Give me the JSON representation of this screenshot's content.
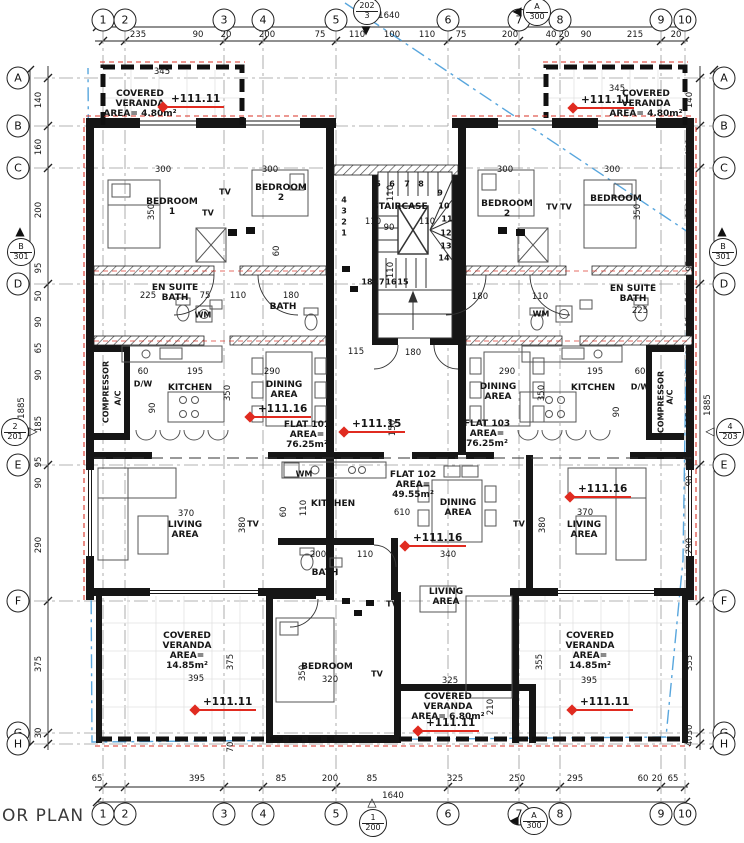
{
  "meta": {
    "plan_label": "OR PLAN"
  },
  "colors": {
    "wall": "#161616",
    "grid_line": "#9a9a9a",
    "chain_line": "#222222",
    "boundary_blue": "#58a6dd",
    "insulation_red": "#d93025",
    "elevation_red": "#e02b20"
  },
  "overall_dimensions": {
    "top": "1640",
    "bottom": "1640",
    "left": "1885",
    "right": "1885"
  },
  "grid": {
    "columns": [
      {
        "label": "1",
        "x": 103
      },
      {
        "label": "2",
        "x": 125
      },
      {
        "label": "3",
        "x": 224
      },
      {
        "label": "4",
        "x": 263
      },
      {
        "label": "5",
        "x": 336
      },
      {
        "label": "6",
        "x": 448
      },
      {
        "label": "7",
        "x": 519
      },
      {
        "label": "8",
        "x": 560
      },
      {
        "label": "9",
        "x": 661
      },
      {
        "label": "10",
        "x": 685
      }
    ],
    "rows": [
      {
        "label": "A",
        "y": 78
      },
      {
        "label": "B",
        "y": 126
      },
      {
        "label": "C",
        "y": 168
      },
      {
        "label": "D",
        "y": 284
      },
      {
        "label": "E",
        "y": 465
      },
      {
        "label": "F",
        "y": 601
      },
      {
        "label": "G",
        "y": 733
      },
      {
        "label": "H",
        "y": 744
      }
    ]
  },
  "dimensions": {
    "top": [
      {
        "t": "235",
        "x": 138
      },
      {
        "t": "90",
        "x": 198
      },
      {
        "t": "20",
        "x": 226
      },
      {
        "t": "200",
        "x": 267
      },
      {
        "t": "75",
        "x": 320
      },
      {
        "t": "110",
        "x": 357
      },
      {
        "t": "100",
        "x": 392
      },
      {
        "t": "110",
        "x": 427
      },
      {
        "t": "75",
        "x": 461
      },
      {
        "t": "200",
        "x": 510
      },
      {
        "t": "40",
        "x": 551
      },
      {
        "t": "20",
        "x": 564
      },
      {
        "t": "90",
        "x": 586
      },
      {
        "t": "215",
        "x": 635
      },
      {
        "t": "20",
        "x": 676
      }
    ],
    "bottom": [
      {
        "t": "65",
        "x": 97
      },
      {
        "t": "395",
        "x": 197
      },
      {
        "t": "85",
        "x": 281
      },
      {
        "t": "200",
        "x": 330
      },
      {
        "t": "85",
        "x": 372
      },
      {
        "t": "325",
        "x": 455
      },
      {
        "t": "250",
        "x": 517
      },
      {
        "t": "295",
        "x": 575
      },
      {
        "t": "60",
        "x": 643
      },
      {
        "t": "20",
        "x": 657
      },
      {
        "t": "65",
        "x": 673
      }
    ],
    "left": [
      {
        "t": "140",
        "y": 100
      },
      {
        "t": "160",
        "y": 147
      },
      {
        "t": "200",
        "y": 210
      },
      {
        "t": "95",
        "y": 268
      },
      {
        "t": "50",
        "y": 296
      },
      {
        "t": "90",
        "y": 322
      },
      {
        "t": "65",
        "y": 348
      },
      {
        "t": "90",
        "y": 375
      },
      {
        "t": "185",
        "y": 424
      },
      {
        "t": "95",
        "y": 462
      },
      {
        "t": "90",
        "y": 483
      },
      {
        "t": "290",
        "y": 545
      },
      {
        "t": "375",
        "y": 664
      },
      {
        "t": "30",
        "y": 733
      }
    ],
    "right": [
      {
        "t": "140",
        "y": 100
      },
      {
        "t": "160",
        "y": 147
      },
      {
        "t": "200",
        "y": 210
      },
      {
        "t": "95",
        "y": 266
      },
      {
        "t": "50",
        "y": 297
      },
      {
        "t": "95",
        "y": 322
      },
      {
        "t": "60",
        "y": 350
      },
      {
        "t": "90",
        "y": 375
      },
      {
        "t": "185",
        "y": 420
      },
      {
        "t": "95",
        "y": 461
      },
      {
        "t": "90",
        "y": 481
      },
      {
        "t": "290",
        "y": 546
      },
      {
        "t": "355",
        "y": 663
      },
      {
        "t": "30",
        "y": 730
      },
      {
        "t": "40",
        "y": 741
      }
    ],
    "inner_h": [
      {
        "t": "345",
        "x": 162,
        "y": 72
      },
      {
        "t": "345",
        "x": 617,
        "y": 89
      },
      {
        "t": "300",
        "x": 163,
        "y": 170
      },
      {
        "t": "300",
        "x": 270,
        "y": 170
      },
      {
        "t": "300",
        "x": 505,
        "y": 170
      },
      {
        "t": "300",
        "x": 612,
        "y": 170
      },
      {
        "t": "225",
        "x": 148,
        "y": 296
      },
      {
        "t": "75",
        "x": 205,
        "y": 296
      },
      {
        "t": "110",
        "x": 238,
        "y": 296
      },
      {
        "t": "180",
        "x": 291,
        "y": 296
      },
      {
        "t": "180",
        "x": 480,
        "y": 297
      },
      {
        "t": "110",
        "x": 540,
        "y": 297
      },
      {
        "t": "225",
        "x": 640,
        "y": 311
      },
      {
        "t": "60",
        "x": 143,
        "y": 372
      },
      {
        "t": "195",
        "x": 195,
        "y": 372
      },
      {
        "t": "290",
        "x": 272,
        "y": 372
      },
      {
        "t": "290",
        "x": 507,
        "y": 372
      },
      {
        "t": "195",
        "x": 595,
        "y": 372
      },
      {
        "t": "60",
        "x": 640,
        "y": 372
      },
      {
        "t": "110",
        "x": 373,
        "y": 222
      },
      {
        "t": "90",
        "x": 389,
        "y": 228
      },
      {
        "t": "110",
        "x": 427,
        "y": 222
      },
      {
        "t": "115",
        "x": 356,
        "y": 352
      },
      {
        "t": "180",
        "x": 413,
        "y": 353
      },
      {
        "t": "610",
        "x": 402,
        "y": 513
      },
      {
        "t": "200",
        "x": 318,
        "y": 555
      },
      {
        "t": "110",
        "x": 365,
        "y": 555
      },
      {
        "t": "340",
        "x": 448,
        "y": 555
      },
      {
        "t": "370",
        "x": 186,
        "y": 514
      },
      {
        "t": "370",
        "x": 585,
        "y": 513
      },
      {
        "t": "395",
        "x": 196,
        "y": 679
      },
      {
        "t": "395",
        "x": 589,
        "y": 681
      },
      {
        "t": "325",
        "x": 450,
        "y": 681
      },
      {
        "t": "320",
        "x": 330,
        "y": 680
      }
    ],
    "inner_v": [
      {
        "t": "350",
        "x": 152,
        "y": 212
      },
      {
        "t": "350",
        "x": 638,
        "y": 212
      },
      {
        "t": "350",
        "x": 228,
        "y": 393
      },
      {
        "t": "350",
        "x": 542,
        "y": 393
      },
      {
        "t": "150",
        "x": 393,
        "y": 428
      },
      {
        "t": "110",
        "x": 391,
        "y": 193
      },
      {
        "t": "110",
        "x": 391,
        "y": 270
      },
      {
        "t": "110",
        "x": 304,
        "y": 508
      },
      {
        "t": "60",
        "x": 284,
        "y": 512
      },
      {
        "t": "380",
        "x": 243,
        "y": 525
      },
      {
        "t": "380",
        "x": 543,
        "y": 525
      },
      {
        "t": "375",
        "x": 231,
        "y": 662
      },
      {
        "t": "355",
        "x": 540,
        "y": 662
      },
      {
        "t": "210",
        "x": 491,
        "y": 707
      },
      {
        "t": "350",
        "x": 303,
        "y": 673
      },
      {
        "t": "70",
        "x": 231,
        "y": 747
      },
      {
        "t": "90",
        "x": 153,
        "y": 408
      },
      {
        "t": "90",
        "x": 617,
        "y": 412
      },
      {
        "t": "60",
        "x": 277,
        "y": 251
      }
    ]
  },
  "rooms": [
    {
      "id": "covered-veranda-top-left",
      "lines": [
        "COVERED",
        "VERANDA",
        "AREA= 4.80m²"
      ],
      "x": 140,
      "y": 104
    },
    {
      "id": "covered-veranda-top-right",
      "lines": [
        "COVERED",
        "VERANDA",
        "AREA= 4.80m²"
      ],
      "x": 646,
      "y": 104
    },
    {
      "id": "bedroom-1-left",
      "lines": [
        "BEDROOM",
        "1"
      ],
      "x": 172,
      "y": 207
    },
    {
      "id": "bedroom-2-left",
      "lines": [
        "BEDROOM",
        "2"
      ],
      "x": 281,
      "y": 193
    },
    {
      "id": "staircase",
      "lines": [
        "STAIRCASE"
      ],
      "x": 400,
      "y": 207
    },
    {
      "id": "bedroom-2-right",
      "lines": [
        "BEDROOM",
        "2"
      ],
      "x": 507,
      "y": 209
    },
    {
      "id": "bedroom-right",
      "lines": [
        "BEDROOM"
      ],
      "x": 616,
      "y": 199
    },
    {
      "id": "en-suite-bath-left",
      "lines": [
        "EN SUITE",
        "BATH"
      ],
      "x": 175,
      "y": 293
    },
    {
      "id": "bath-left",
      "lines": [
        "BATH"
      ],
      "x": 283,
      "y": 307
    },
    {
      "id": "en-suite-bath-right",
      "lines": [
        "EN SUITE",
        "BATH"
      ],
      "x": 633,
      "y": 294
    },
    {
      "id": "kitchen-left",
      "lines": [
        "KITCHEN"
      ],
      "x": 190,
      "y": 388
    },
    {
      "id": "dining-area-left",
      "lines": [
        "DINING",
        "AREA"
      ],
      "x": 284,
      "y": 390
    },
    {
      "id": "kitchen-right",
      "lines": [
        "KITCHEN"
      ],
      "x": 593,
      "y": 388
    },
    {
      "id": "dining-area-right",
      "lines": [
        "DINING",
        "AREA"
      ],
      "x": 498,
      "y": 392
    },
    {
      "id": "flat-101",
      "lines": [
        "FLAT 101",
        "AREA=",
        "76.25m²"
      ],
      "x": 307,
      "y": 435
    },
    {
      "id": "flat-103",
      "lines": [
        "FLAT 103",
        "AREA=",
        "76.25m²"
      ],
      "x": 487,
      "y": 434
    },
    {
      "id": "flat-102",
      "lines": [
        "FLAT 102",
        "AREA=",
        "49.55m²"
      ],
      "x": 413,
      "y": 485
    },
    {
      "id": "kitchen-center",
      "lines": [
        "KITCHEN"
      ],
      "x": 333,
      "y": 504
    },
    {
      "id": "dining-area-center",
      "lines": [
        "DINING",
        "AREA"
      ],
      "x": 458,
      "y": 508
    },
    {
      "id": "living-area-left",
      "lines": [
        "LIVING",
        "AREA"
      ],
      "x": 185,
      "y": 530
    },
    {
      "id": "living-area-right",
      "lines": [
        "LIVING",
        "AREA"
      ],
      "x": 584,
      "y": 530
    },
    {
      "id": "bath-center",
      "lines": [
        "BATH"
      ],
      "x": 325,
      "y": 573
    },
    {
      "id": "living-area-center",
      "lines": [
        "LIVING",
        "AREA"
      ],
      "x": 446,
      "y": 597
    },
    {
      "id": "bedroom-bottom",
      "lines": [
        "BEDROOM"
      ],
      "x": 327,
      "y": 667
    },
    {
      "id": "covered-veranda-bottom-left",
      "lines": [
        "COVERED",
        "VERANDA",
        "AREA=",
        "14.85m²"
      ],
      "x": 187,
      "y": 651
    },
    {
      "id": "covered-veranda-bottom-right",
      "lines": [
        "COVERED",
        "VERANDA",
        "AREA=",
        "14.85m²"
      ],
      "x": 590,
      "y": 651
    },
    {
      "id": "covered-veranda-bottom-center",
      "lines": [
        "COVERED",
        "VERANDA",
        "AREA= 6.80m²"
      ],
      "x": 448,
      "y": 707
    }
  ],
  "small_labels": [
    {
      "t": "TV",
      "x": 225,
      "y": 192
    },
    {
      "t": "TV",
      "x": 208,
      "y": 213
    },
    {
      "t": "TV",
      "x": 552,
      "y": 207
    },
    {
      "t": "TV",
      "x": 566,
      "y": 207
    },
    {
      "t": "TV",
      "x": 253,
      "y": 524
    },
    {
      "t": "TV",
      "x": 519,
      "y": 524
    },
    {
      "t": "TV",
      "x": 392,
      "y": 604
    },
    {
      "t": "TV",
      "x": 377,
      "y": 674
    },
    {
      "t": "WM",
      "x": 203,
      "y": 315
    },
    {
      "t": "WM",
      "x": 304,
      "y": 474
    },
    {
      "t": "WM",
      "x": 541,
      "y": 314
    },
    {
      "t": "D/W",
      "x": 143,
      "y": 384
    },
    {
      "t": "D/W",
      "x": 640,
      "y": 387
    },
    {
      "t": "COMPRESSOR",
      "x": 106,
      "y": 392,
      "rot": true
    },
    {
      "t": "COMPRESSOR",
      "x": 661,
      "y": 402,
      "rot": true
    },
    {
      "t": "A/C",
      "x": 118,
      "y": 398,
      "rot": true
    },
    {
      "t": "A/C",
      "x": 670,
      "y": 397,
      "rot": true
    }
  ],
  "stair_numbers": [
    {
      "t": "1",
      "x": 344,
      "y": 233
    },
    {
      "t": "2",
      "x": 344,
      "y": 222
    },
    {
      "t": "3",
      "x": 344,
      "y": 211
    },
    {
      "t": "4",
      "x": 344,
      "y": 200
    },
    {
      "t": "5",
      "x": 378,
      "y": 184
    },
    {
      "t": "6",
      "x": 392,
      "y": 184
    },
    {
      "t": "7",
      "x": 407,
      "y": 184
    },
    {
      "t": "8",
      "x": 421,
      "y": 184
    },
    {
      "t": "9",
      "x": 440,
      "y": 193
    },
    {
      "t": "10",
      "x": 444,
      "y": 206
    },
    {
      "t": "11",
      "x": 447,
      "y": 219
    },
    {
      "t": "12",
      "x": 446,
      "y": 233
    },
    {
      "t": "13",
      "x": 446,
      "y": 246
    },
    {
      "t": "14",
      "x": 444,
      "y": 258
    },
    {
      "t": "15",
      "x": 403,
      "y": 282
    },
    {
      "t": "16",
      "x": 391,
      "y": 282
    },
    {
      "t": "17",
      "x": 379,
      "y": 282
    },
    {
      "t": "18",
      "x": 367,
      "y": 282
    }
  ],
  "elevation_markers": [
    {
      "t": "+111.11",
      "x": 163,
      "y": 107
    },
    {
      "t": "+111.11",
      "x": 573,
      "y": 108
    },
    {
      "t": "+111.16",
      "x": 250,
      "y": 417
    },
    {
      "t": "+111.15",
      "x": 344,
      "y": 432
    },
    {
      "t": "+111.16",
      "x": 405,
      "y": 546
    },
    {
      "t": "+111.16",
      "x": 570,
      "y": 497
    },
    {
      "t": "+111.11",
      "x": 195,
      "y": 710
    },
    {
      "t": "+111.11",
      "x": 418,
      "y": 731
    },
    {
      "t": "+111.11",
      "x": 572,
      "y": 710
    }
  ],
  "section_markers": [
    {
      "top": "202",
      "bottom": "3",
      "x": 366,
      "y": 10,
      "tri": "down",
      "filled": true
    },
    {
      "top": "A",
      "bottom": "300",
      "x": 536,
      "y": 11,
      "tri": "left",
      "filled": true
    },
    {
      "top": "B",
      "bottom": "301",
      "x": 20,
      "y": 251,
      "tri": "up",
      "filled": true
    },
    {
      "top": "2",
      "bottom": "201",
      "x": 14,
      "y": 431,
      "tri": "right",
      "filled": false
    },
    {
      "top": "B",
      "bottom": "301",
      "x": 722,
      "y": 251,
      "tri": "up",
      "filled": true
    },
    {
      "top": "4",
      "bottom": "203",
      "x": 729,
      "y": 431,
      "tri": "left",
      "filled": false
    },
    {
      "top": "1",
      "bottom": "200",
      "x": 372,
      "y": 822,
      "tri": "up",
      "filled": false
    },
    {
      "top": "A",
      "bottom": "300",
      "x": 533,
      "y": 820,
      "tri": "left",
      "filled": true
    }
  ]
}
